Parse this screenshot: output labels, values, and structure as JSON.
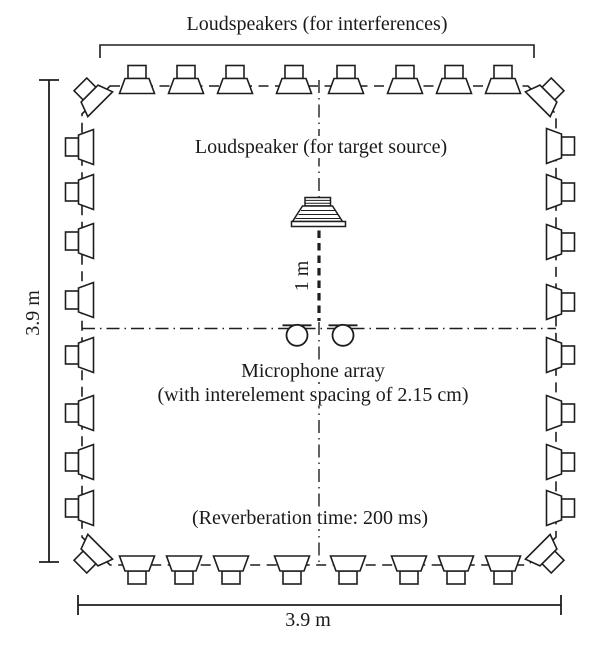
{
  "meta": {
    "background_color": "#ffffff",
    "ink_color": "#1e1e1e",
    "description": "Experimental room setup diagram with loudspeaker ring, target loudspeaker and microphone array"
  },
  "labels": {
    "interference_title": "Loudspeakers (for interferences)",
    "target_source": "Loudspeaker (for target source)",
    "distance": "1 m",
    "mic_array_1": "Microphone array",
    "mic_array_2": "(with interelement spacing of 2.15 cm)",
    "reverberation": "(Reverberation time: 200 ms)",
    "dim_height": "3.9 m",
    "dim_width": "3.9 m"
  },
  "icons": {
    "loudspeaker": "loudspeaker-icon",
    "target_loudspeaker": "target-loudspeaker-icon",
    "microphone": "microphone-icon"
  },
  "speakers": {
    "top": {
      "mouth_y": 93.5,
      "xs": [
        137,
        186,
        235,
        294,
        346,
        405,
        454,
        503
      ]
    },
    "bottom": {
      "mouth_y": 556,
      "xs": [
        137,
        184,
        231,
        292,
        348,
        409,
        456,
        503
      ]
    },
    "left": {
      "mouth_x": 93.5,
      "ys": [
        147,
        192,
        241,
        300,
        355,
        413,
        462,
        508
      ]
    },
    "right": {
      "mouth_x": 546.5,
      "ys": [
        146,
        192,
        242,
        302,
        355,
        413,
        462,
        508
      ]
    },
    "corners": [
      {
        "x": 100.2,
        "y": 104.2,
        "rotate": 45
      },
      {
        "x": 537.8,
        "y": 104.2,
        "rotate": 135
      },
      {
        "x": 537.8,
        "y": 546.8,
        "rotate": 225
      },
      {
        "x": 100.2,
        "y": 546.8,
        "rotate": 315
      }
    ]
  },
  "mics": {
    "circles": [
      {
        "cx": 297,
        "cy": 335.3,
        "r": 10.5
      },
      {
        "cx": 343,
        "cy": 335.3,
        "r": 10.5
      }
    ],
    "bar_y": 325.3,
    "bar_half_width": 14.5
  }
}
